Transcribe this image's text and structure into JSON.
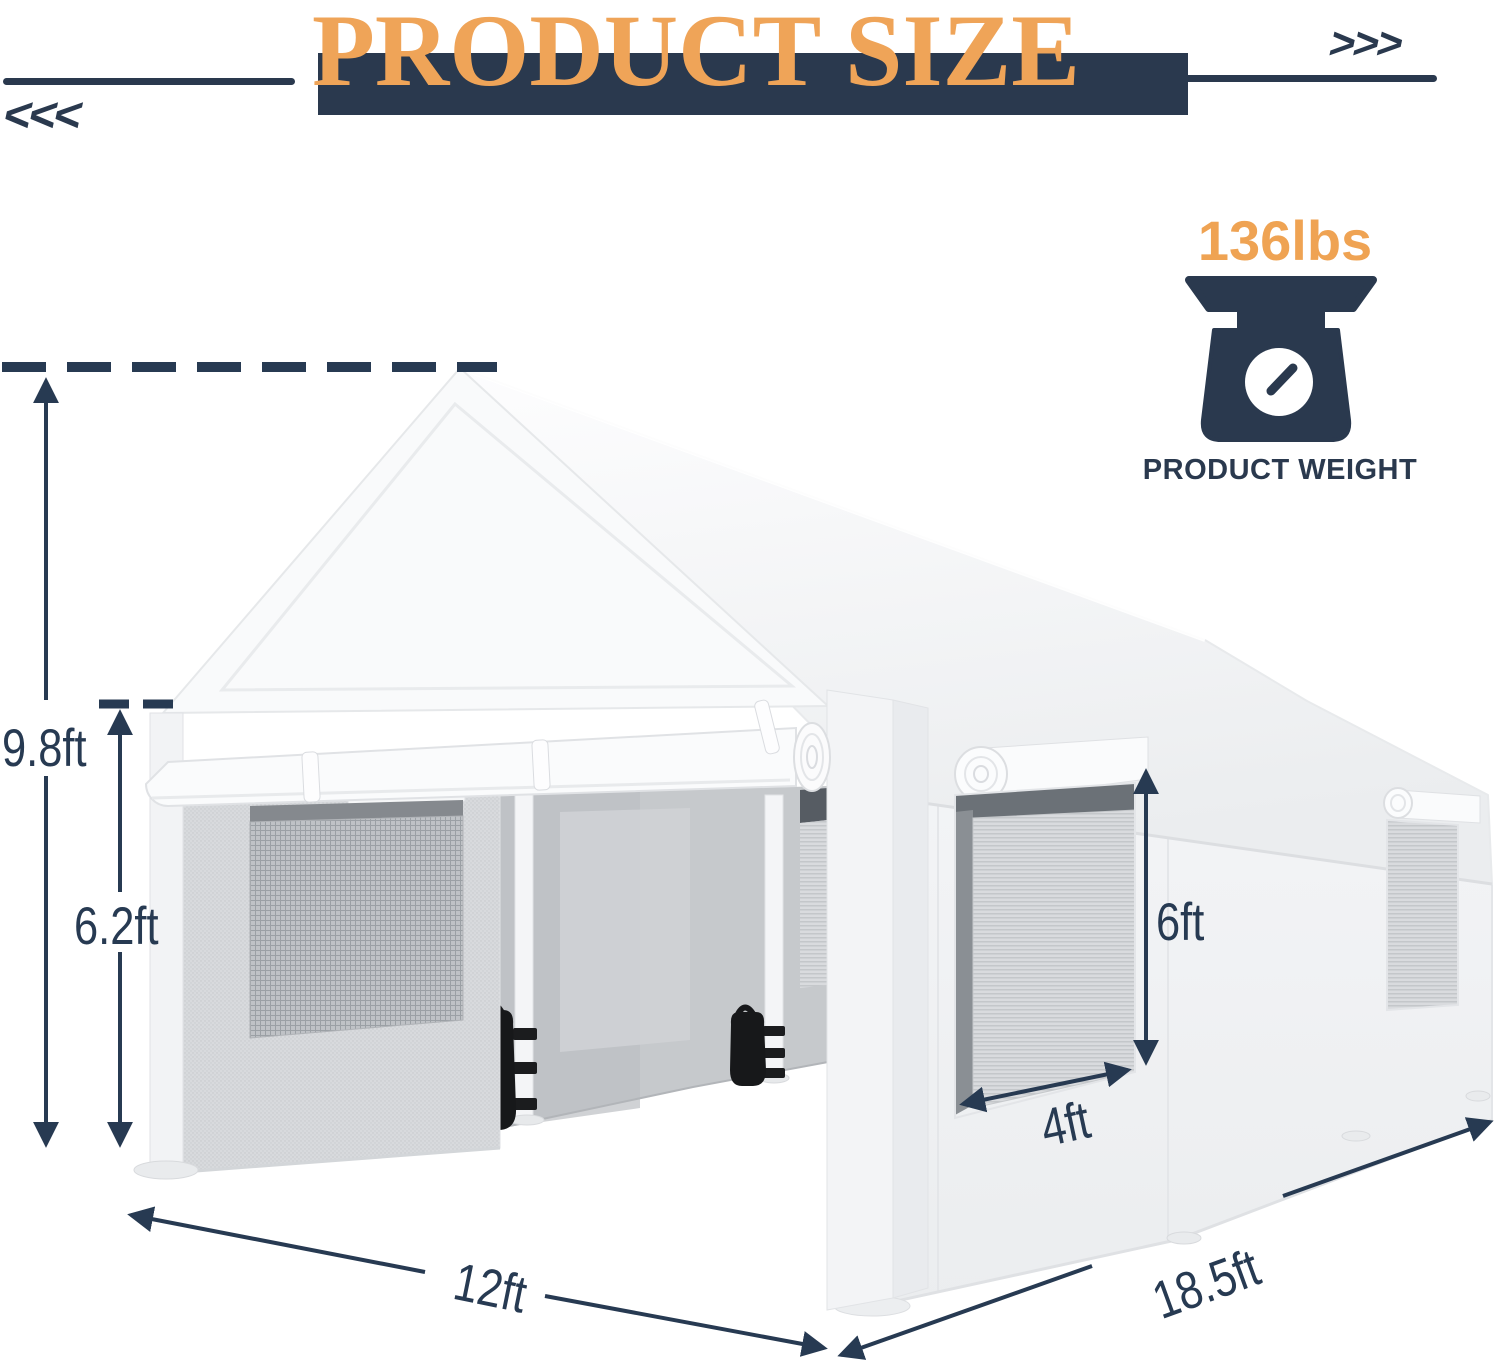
{
  "title": {
    "text": "PRODUCT SIZE"
  },
  "decor": {
    "left_chevrons": "<<<",
    "right_chevrons": ">>>"
  },
  "weight": {
    "value": "136lbs",
    "caption": "PRODUCT WEIGHT"
  },
  "dimensions": {
    "total_height": "9.8ft",
    "side_height": "6.2ft",
    "window_height": "6ft",
    "window_width": "4ft",
    "front_width": "12ft",
    "side_length": "18.5ft"
  },
  "colors": {
    "accent_orange": "#EFA458",
    "navy": "#2A394E",
    "dimension_navy": "#273A52",
    "tent_white": "#F6F7F9",
    "interior_gray": "#C6C9CC"
  }
}
